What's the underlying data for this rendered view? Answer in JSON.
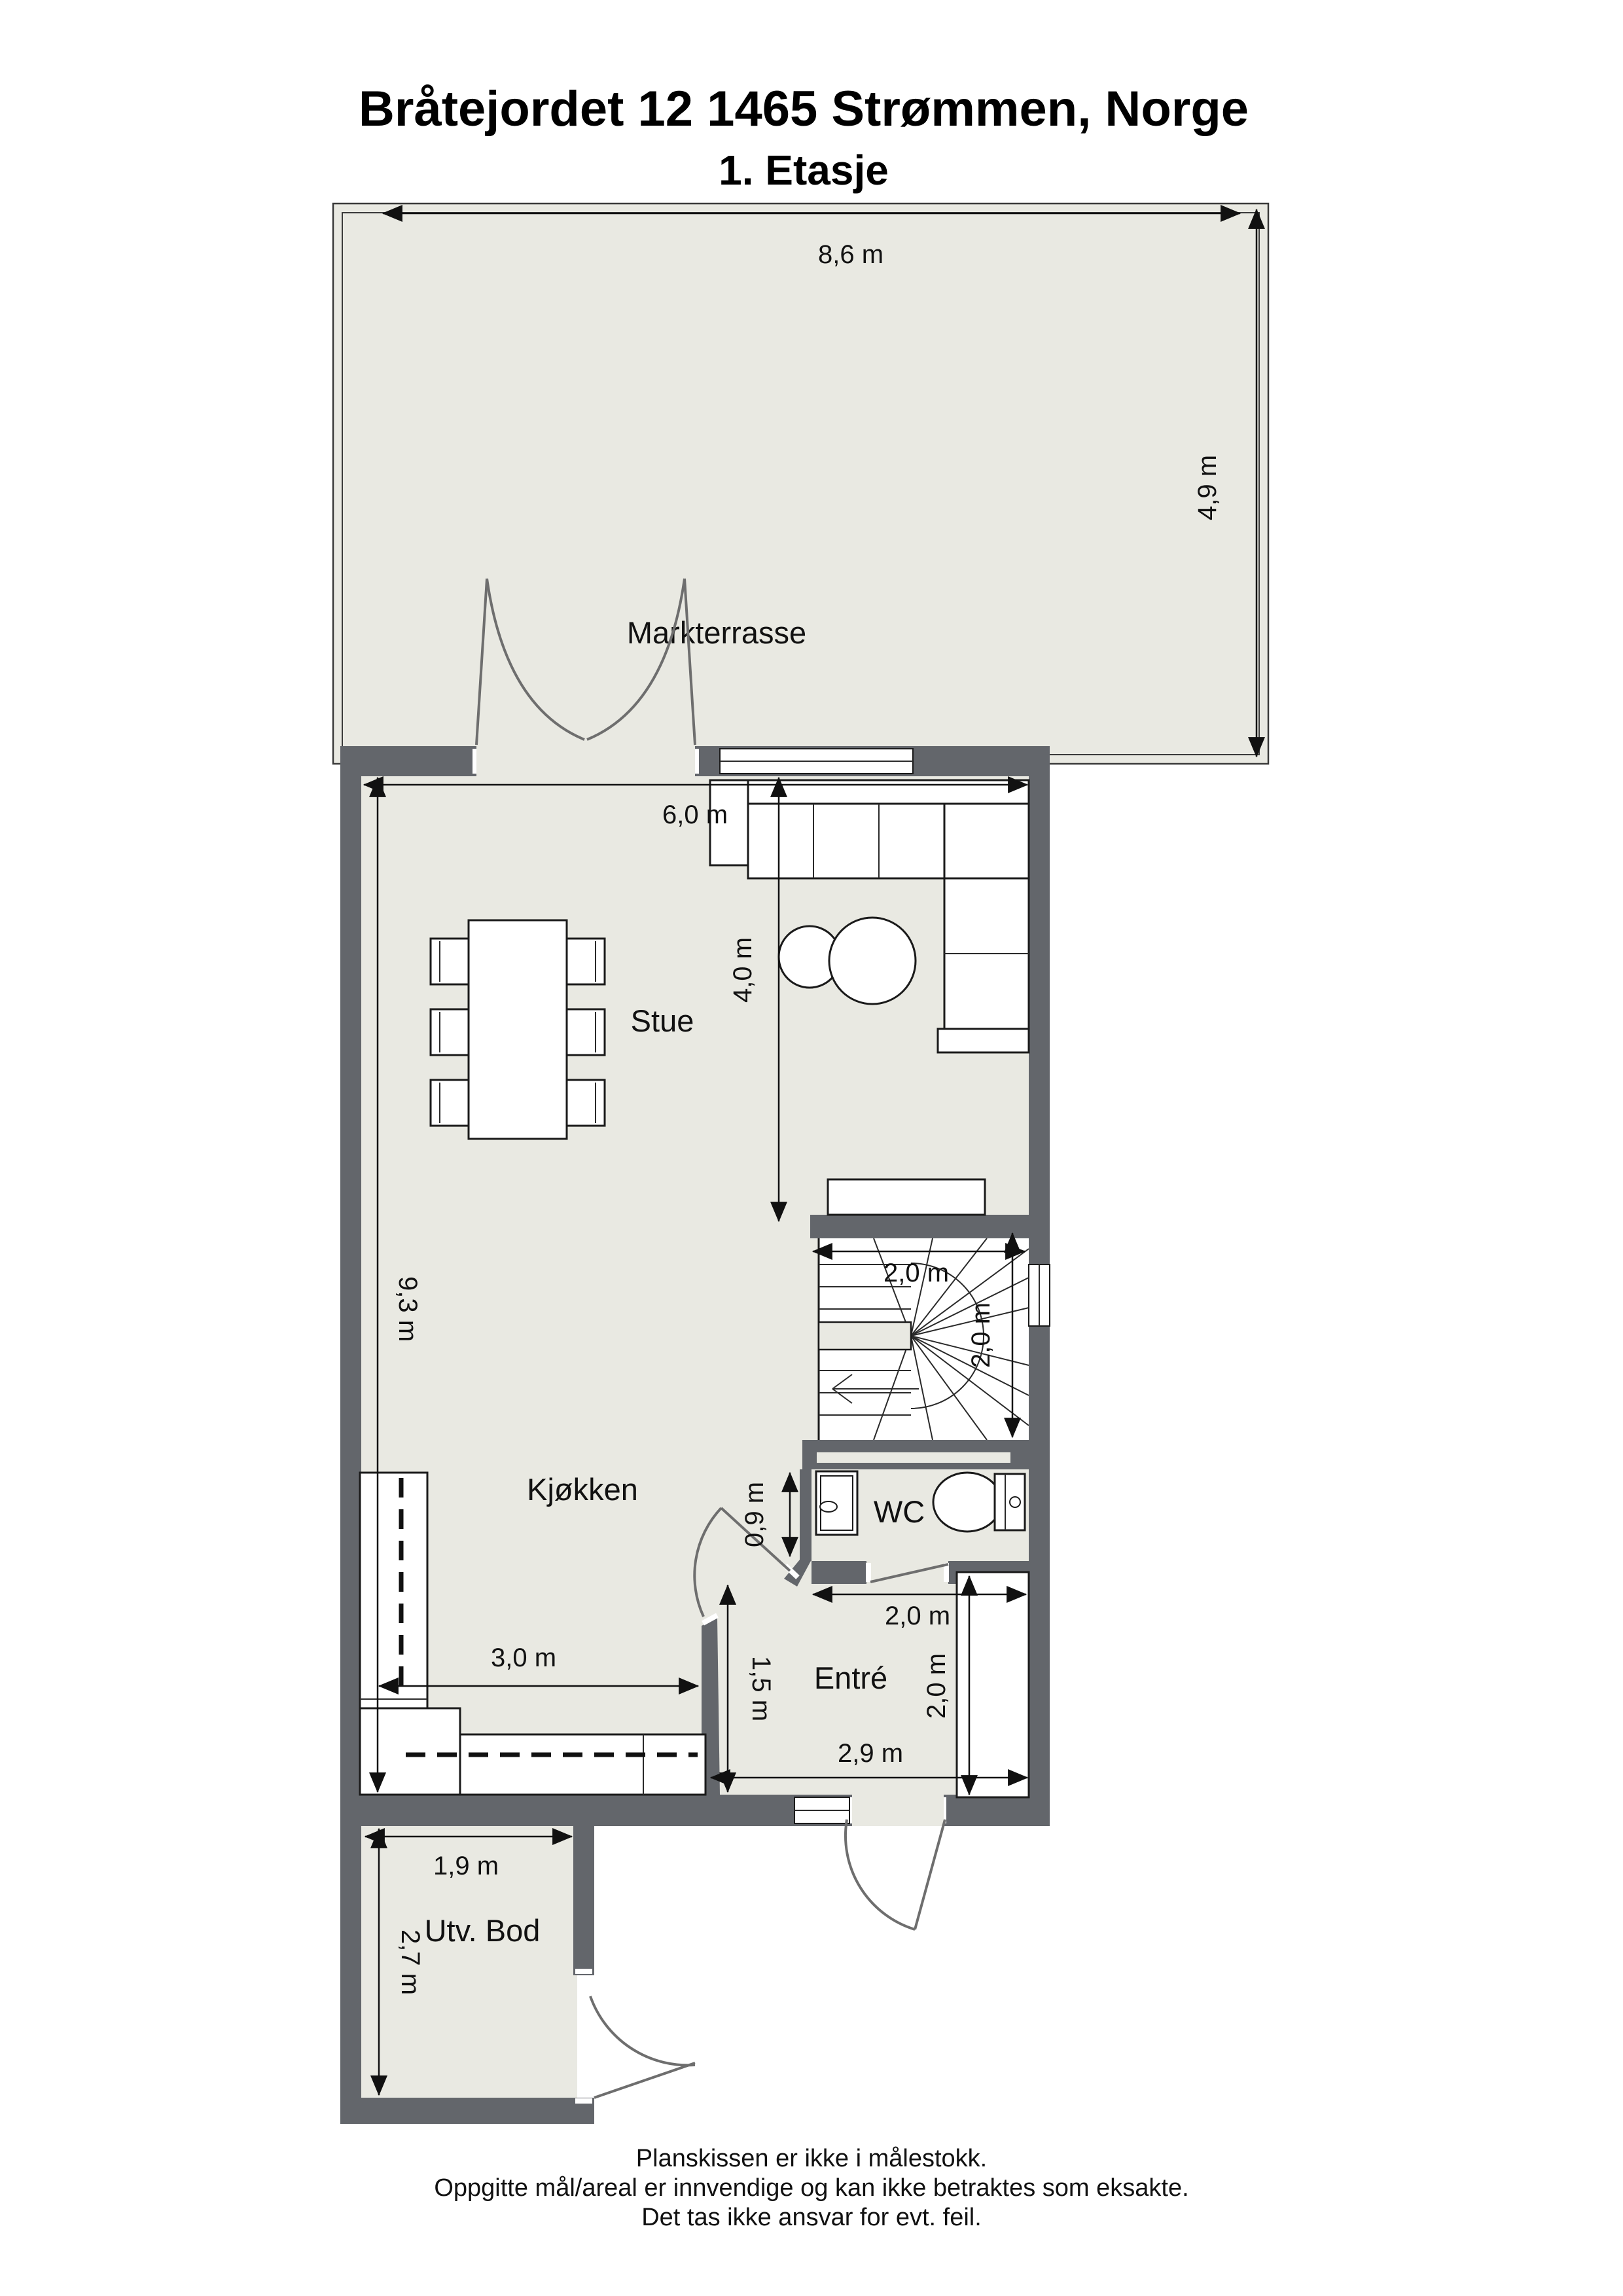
{
  "page": {
    "title": "Bråtejordet 12 1465 Strømmen, Norge",
    "subtitle": "1. Etasje"
  },
  "colors": {
    "wall": "#63666B",
    "floor": "#E9E9E2",
    "outline": "#1A1A1A",
    "door_arc": "#6E6E6E",
    "background": "#FFFFFF"
  },
  "rooms": {
    "terrace": "Markterrasse",
    "living": "Stue",
    "kitchen": "Kjøkken",
    "wc": "WC",
    "entry": "Entré",
    "storage": "Utv. Bod"
  },
  "dims": {
    "terrace_width": "8,6 m",
    "terrace_depth": "4,9 m",
    "stue_width": "6,0 m",
    "stue_depth": "4,0 m",
    "interior_depth": "9,3 m",
    "stair_width": "2,0 m",
    "stair_depth": "2,0 m",
    "wc_depth": "0,9 m",
    "wc_width": "2,0 m",
    "entry_depth": "2,0 m",
    "kitchen_width": "3,0 m",
    "passage_depth": "1,5 m",
    "entry_width": "2,9 m",
    "bod_width": "1,9 m",
    "bod_depth": "2,7 m"
  },
  "footer": {
    "line1": "Planskissen er ikke i målestokk.",
    "line2": "Oppgitte mål/areal er innvendige og kan ikke betraktes som eksakte.",
    "line3": "Det tas ikke ansvar for evt. feil."
  }
}
